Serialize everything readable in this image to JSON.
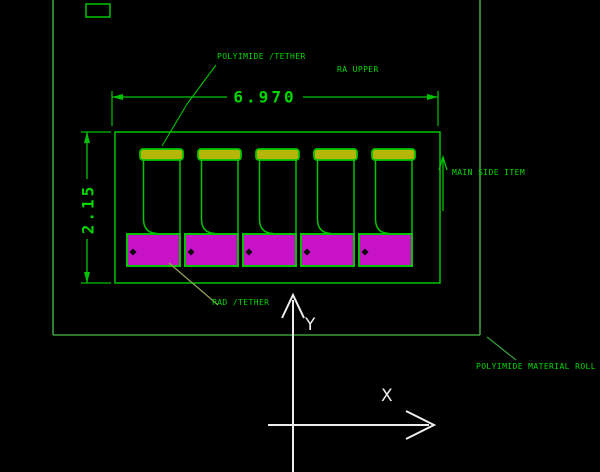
{
  "app": {
    "type": "cad-drawing-viewport",
    "background": "#000000"
  },
  "drawing": {
    "labels": {
      "polyimide_tether": "POLYIMIDE /TETHER",
      "ra_upper": "RA UPPER",
      "main_side": "MAIN SIDE ITEM",
      "pad_tether": "PAD /TETHER",
      "material_roll": "POLYIMIDE MATERIAL ROLL"
    },
    "dimensions": {
      "width_label": "6.970",
      "height_label": "2.15"
    },
    "axes": {
      "x_label": "X",
      "y_label": "Y"
    },
    "cells": {
      "count": 5
    },
    "colors": {
      "entity_green": "#00C400",
      "frame_green": "#3C9E3C",
      "text_green": "#00D800",
      "pad_magenta": "#C712C7",
      "bar_yellow": "#B5B50A",
      "axis_white": "#EDEDED",
      "leader_olive": "#93A35A",
      "marker_black": "#0A0A0A"
    }
  }
}
